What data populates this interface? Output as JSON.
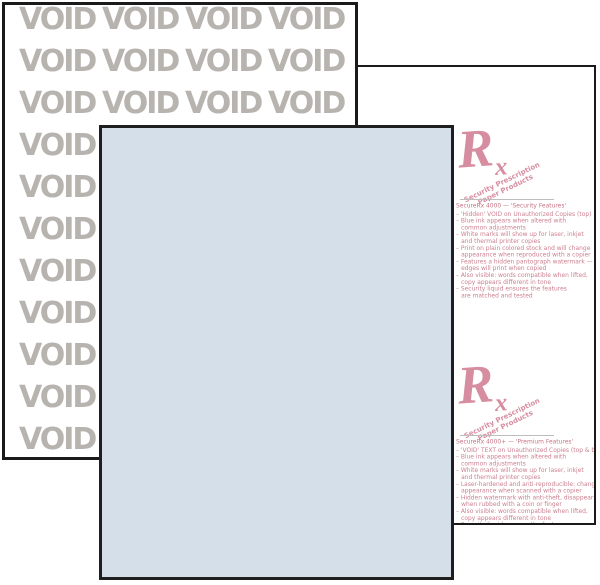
{
  "scene": {
    "description": "Product photo of three fanned sheets of tamper-resistant prescription security paper",
    "background_color": "#ffffff"
  },
  "void_sheet": {
    "watermark_text": "VOID",
    "rows": 11,
    "cols": 4,
    "text_color": "#b7b3af",
    "paper_color": "#ffffff",
    "border_color": "#1a1a1a"
  },
  "blue_sheet": {
    "paper_color": "#d5dfe9",
    "border_color": "#1f1f1f"
  },
  "rx_sheet": {
    "paper_color": "#ffffff",
    "border_color": "#1a1a1a",
    "accent_color": "#d78da0",
    "text_color": "#cc8090",
    "blocks": [
      {
        "rx_symbol": "R",
        "rx_sub": "x",
        "tagline_line1": "Security Prescription",
        "tagline_line2": "Paper Products",
        "heading": "SecureRx 4000 — 'Security Features'",
        "features": [
          {
            "line1": "– 'Hidden' VOID on Unauthorized Copies (top)"
          },
          {
            "line1": "– Blue ink appears when altered with",
            "line2": "common adjustments"
          },
          {
            "line1": "– White marks will show up for laser, inkjet",
            "line2": "and thermal printer copies"
          },
          {
            "line1": "– Print on plain colored stock and will change",
            "line2": "appearance when reproduced with a copier"
          },
          {
            "line1": "– Features a hidden pantograph watermark —",
            "line2": "edges will print when copied"
          },
          {
            "line1": "– Also visible: words compatible when lifted,",
            "line2": "copy appears different in tone"
          },
          {
            "line1": "– Security liquid ensures the features",
            "line2": "are matched and tested"
          }
        ]
      },
      {
        "rx_symbol": "R",
        "rx_sub": "x",
        "tagline_line1": "Security Prescription",
        "tagline_line2": "Paper Products",
        "heading": "SecureRx 4000+ — 'Premium Features'",
        "features": [
          {
            "line1": "– 'VOID' TEXT on Unauthorized Copies (top & back)"
          },
          {
            "line1": "– Blue ink appears when altered with",
            "line2": "common adjustments"
          },
          {
            "line1": "– White marks will show up for laser, inkjet",
            "line2": "and thermal printer copies"
          },
          {
            "line1": "– Laser-hardened and anti-reproducible: changes",
            "line2": "appearance when scanned with a copier"
          },
          {
            "line1": "– Hidden watermark with anti-theft, disappears",
            "line2": "when rubbed with a coin or finger"
          },
          {
            "line1": "– Also visible: words compatible when lifted,",
            "line2": "copy appears different in tone"
          },
          {
            "line1": "– Security liquid ensures the features",
            "line2": "are matched and tested"
          }
        ]
      }
    ]
  }
}
